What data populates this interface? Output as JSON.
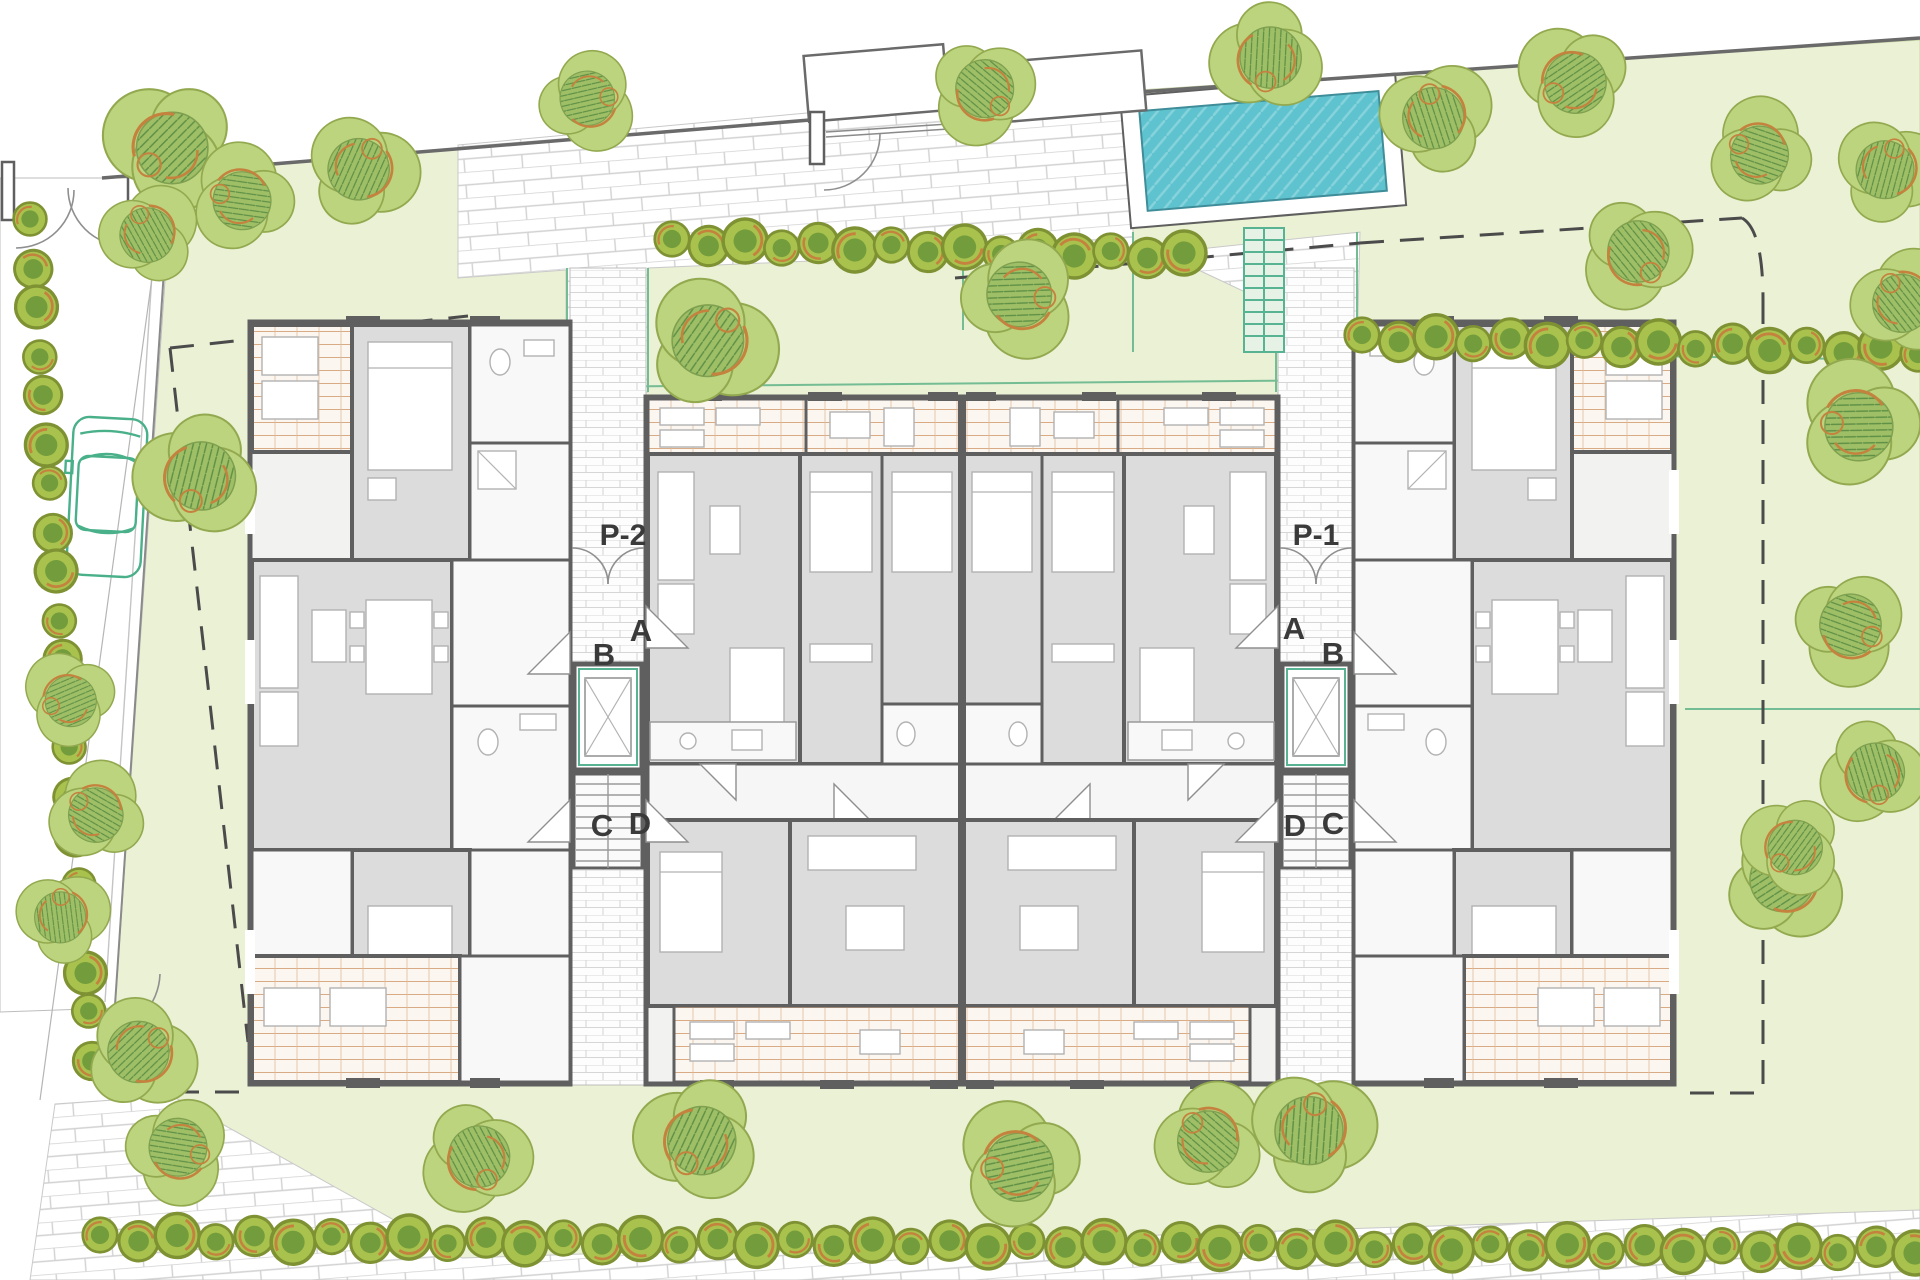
{
  "plan": {
    "type": "architectural-site-plan",
    "labels": {
      "left": {
        "entrance": "P-2",
        "a": "A",
        "b": "B",
        "c": "C",
        "d": "D"
      },
      "right": {
        "entrance": "P-1",
        "a": "A",
        "b": "B",
        "c": "C",
        "d": "D"
      }
    },
    "colors": {
      "lawn": "#eaf1d4",
      "pool_water": "#5fc3cf",
      "pool_hatch": "#86d3dc",
      "wall": "#5f5f5f",
      "room_gray": "#dcdcdc",
      "terrace_line": "#d8ab85",
      "brick_line": "#d2d2d2",
      "tree_fill": "#bcd47e",
      "tree_hatch": "#7ba84e",
      "hedge_fill": "#a9c24d",
      "orange_accent": "#c5823e",
      "teal_accent": "#57b391",
      "boundary_dash": "#4b4b4b"
    },
    "landscape": {
      "trees": [
        [
          168,
          148,
          1.05
        ],
        [
          240,
          198,
          0.85
        ],
        [
          148,
          232,
          0.8
        ],
        [
          362,
          168,
          0.9
        ],
        [
          590,
          100,
          0.8
        ],
        [
          985,
          92,
          0.85
        ],
        [
          1268,
          60,
          0.9
        ],
        [
          1572,
          82,
          0.9
        ],
        [
          1758,
          152,
          0.85
        ],
        [
          1435,
          115,
          0.9
        ],
        [
          712,
          340,
          1.05
        ],
        [
          1022,
          297,
          0.95
        ],
        [
          1638,
          255,
          0.9
        ],
        [
          198,
          478,
          1.0
        ],
        [
          68,
          700,
          0.75
        ],
        [
          95,
          812,
          0.8
        ],
        [
          62,
          915,
          0.75
        ],
        [
          142,
          1052,
          0.9
        ],
        [
          180,
          1150,
          0.85
        ],
        [
          478,
          1160,
          0.9
        ],
        [
          698,
          1142,
          1.0
        ],
        [
          1016,
          1165,
          1.0
        ],
        [
          1208,
          1138,
          0.9
        ],
        [
          1312,
          1128,
          1.0
        ],
        [
          1786,
          880,
          0.95
        ],
        [
          1852,
          628,
          0.9
        ],
        [
          1874,
          775,
          0.85
        ],
        [
          1792,
          848,
          0.8
        ],
        [
          1856,
          424,
          1.0
        ],
        [
          1902,
          300,
          0.85
        ],
        [
          1888,
          168,
          0.85
        ]
      ],
      "hedge_rows": [
        {
          "x1": 672,
          "y1": 242,
          "x2": 1184,
          "y2": 256,
          "step": 36,
          "r": 21
        },
        {
          "x1": 1362,
          "y1": 338,
          "x2": 1918,
          "y2": 351,
          "step": 37,
          "r": 21
        },
        {
          "x1": 100,
          "y1": 1238,
          "x2": 1915,
          "y2": 1250,
          "step": 38,
          "r": 21
        },
        {
          "x1": 30,
          "y1": 222,
          "x2": 92,
          "y2": 1058,
          "step": 43,
          "r": 20
        }
      ]
    }
  }
}
